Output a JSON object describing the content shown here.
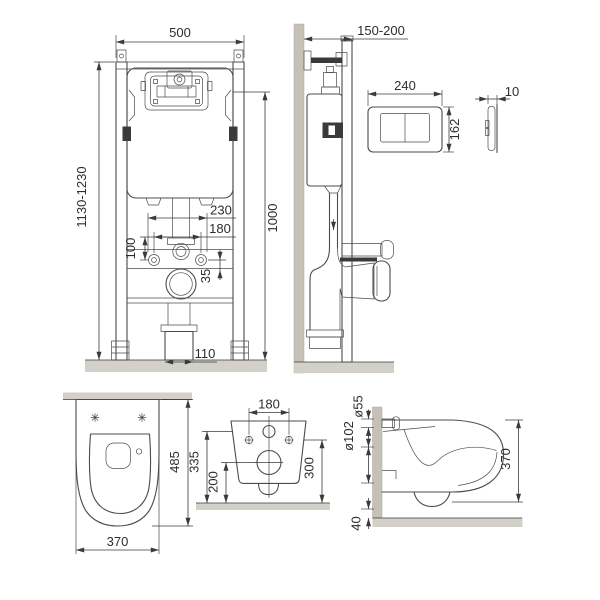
{
  "sheet": {
    "background": "#ffffff",
    "line_color": "#4c4c4c",
    "dim_color": "#333333",
    "wall_fill": "#c6c1b7",
    "floor_fill": "#d3d0c9"
  },
  "views": {
    "frame_front": {
      "dims": {
        "width": "500",
        "height_range": "1130-1230",
        "flush_axis_height": "1000",
        "supply_spacing": "230",
        "bolt_spacing": "180",
        "supply_offset": "100",
        "bracket_offset": "35",
        "outlet_width": "110"
      }
    },
    "frame_side": {
      "dims": {
        "depth_range": "150-200"
      }
    },
    "flush_plate_front": {
      "dims": {
        "width": "240",
        "height": "162"
      }
    },
    "flush_plate_side": {
      "dims": {
        "thickness": "10"
      }
    },
    "bowl_top": {
      "dims": {
        "depth": "485",
        "width": "370"
      }
    },
    "bowl_rear": {
      "dims": {
        "bolt_spacing": "180",
        "inlet_height": "335",
        "outlet_height": "200",
        "bolt_height": "300"
      }
    },
    "bowl_side": {
      "dims": {
        "inlet_diameter": "ø55",
        "outlet_diameter": "ø102",
        "floor_gap": "40",
        "height": "370"
      }
    }
  }
}
